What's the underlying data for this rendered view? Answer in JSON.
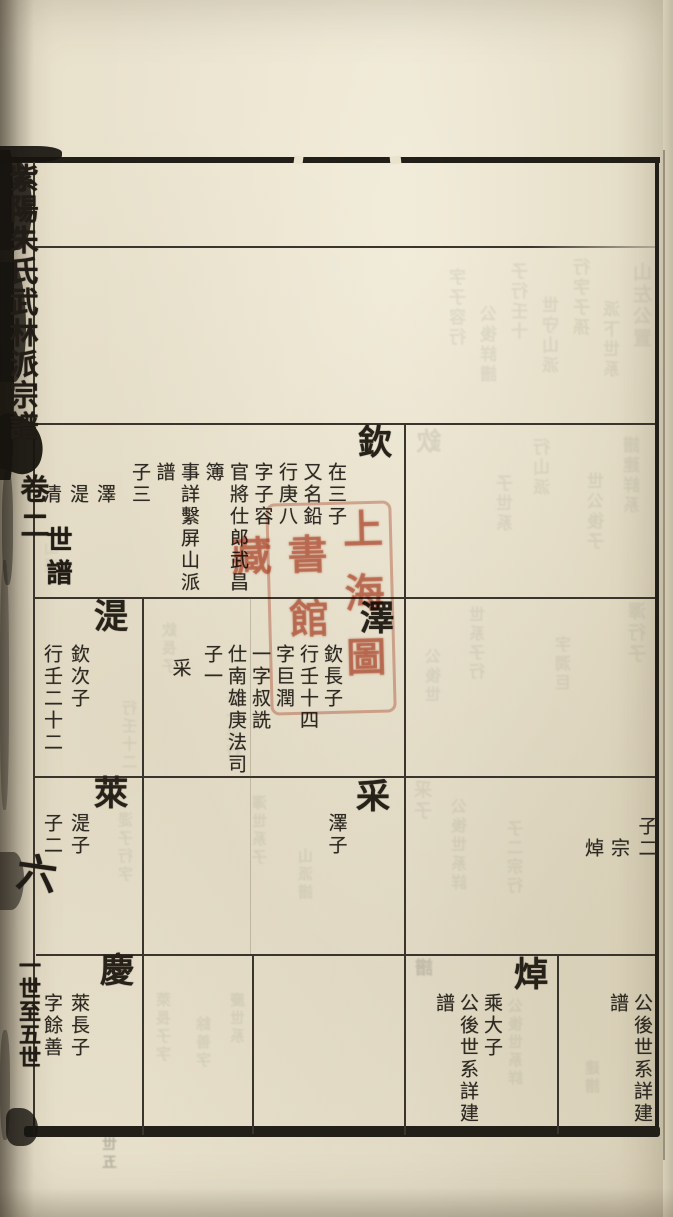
{
  "spine": {
    "title": "紫陽朱氏武林派宗譜",
    "volume": "卷二",
    "section": "世譜",
    "leaf_no": "六",
    "range_note": "一世至五世"
  },
  "cells": {
    "qin": {
      "name": "欽",
      "details": "在三子\n又名鉛\n行庚八\n字子容\n官將仕郎武昌\n簿\n事詳繫屏山派\n譜\n子三",
      "sons": "澤\n湜\n清"
    },
    "ze": {
      "name": "澤",
      "details": "欽長子\n行壬十四\n字巨潤\n一字叔詵\n仕南雄庚法司\n子一",
      "sons": "采"
    },
    "shi": {
      "name": "湜",
      "details": "欽次子\n行壬二十二"
    },
    "lai": {
      "name": "萊",
      "details": "湜子\n子二"
    },
    "cai": {
      "name": "采",
      "details": "澤子"
    },
    "cont": {
      "details": "子二",
      "sons": "宗\n焯"
    },
    "qing": {
      "name": "慶",
      "details": "萊長子\n字餘善"
    },
    "zhuo": {
      "name": "焯",
      "details": "乘大子\n公後世系詳建\n譜"
    },
    "note": {
      "details": "公後世系詳建\n譜"
    }
  },
  "seal": {
    "right_column": "上海圖",
    "left_column": "書館藏",
    "color": "#ba482d"
  },
  "ghosts": [
    {
      "x": 633,
      "y": 262,
      "t": "山左公置",
      "f": 19
    },
    {
      "x": 604,
      "y": 300,
      "t": "派下世系",
      "f": 17
    },
    {
      "x": 574,
      "y": 258,
      "t": "行字子孫",
      "f": 17
    },
    {
      "x": 543,
      "y": 296,
      "t": "世守山派",
      "f": 17
    },
    {
      "x": 512,
      "y": 262,
      "t": "子行壬十",
      "f": 17
    },
    {
      "x": 481,
      "y": 305,
      "t": "公後詳譜",
      "f": 17
    },
    {
      "x": 450,
      "y": 268,
      "t": "字子容行",
      "f": 17
    },
    {
      "x": 416,
      "y": 428,
      "t": "欽",
      "f": 25,
      "o": 0.16
    },
    {
      "x": 624,
      "y": 436,
      "t": "譜建詳系",
      "f": 17
    },
    {
      "x": 588,
      "y": 472,
      "t": "世公後子",
      "f": 17
    },
    {
      "x": 534,
      "y": 438,
      "t": "行山派",
      "f": 17
    },
    {
      "x": 497,
      "y": 474,
      "t": "子世系",
      "f": 17
    },
    {
      "x": 44,
      "y": 540,
      "t": "山派",
      "f": 15,
      "o": 0.1
    },
    {
      "x": 628,
      "y": 602,
      "t": "澤行子",
      "f": 18
    },
    {
      "x": 556,
      "y": 636,
      "t": "字潤巨",
      "f": 16
    },
    {
      "x": 470,
      "y": 606,
      "t": "世系子行",
      "f": 16
    },
    {
      "x": 426,
      "y": 648,
      "t": "公後世",
      "f": 16
    },
    {
      "x": 122,
      "y": 700,
      "t": "行壬十二",
      "f": 15
    },
    {
      "x": 226,
      "y": 690,
      "t": "子一采行",
      "f": 15
    },
    {
      "x": 162,
      "y": 622,
      "t": "欽長子",
      "f": 15
    },
    {
      "x": 118,
      "y": 812,
      "t": "湜子行字",
      "f": 15
    },
    {
      "x": 252,
      "y": 795,
      "t": "澤世系子",
      "f": 15
    },
    {
      "x": 298,
      "y": 848,
      "t": "山派譜",
      "f": 15
    },
    {
      "x": 452,
      "y": 798,
      "t": "公後世系詳",
      "f": 16
    },
    {
      "x": 508,
      "y": 820,
      "t": "子二宗行",
      "f": 16
    },
    {
      "x": 414,
      "y": 780,
      "t": "采子",
      "f": 18
    },
    {
      "x": 156,
      "y": 992,
      "t": "萊長子字",
      "f": 15
    },
    {
      "x": 196,
      "y": 1016,
      "t": "餘善字",
      "f": 15
    },
    {
      "x": 230,
      "y": 992,
      "t": "慶世系",
      "f": 15
    },
    {
      "x": 415,
      "y": 958,
      "t": "譜",
      "f": 18,
      "o": 0.28
    },
    {
      "x": 508,
      "y": 998,
      "t": "公後世系詳",
      "f": 15
    },
    {
      "x": 585,
      "y": 1060,
      "t": "建譜",
      "f": 15
    },
    {
      "x": 102,
      "y": 1136,
      "t": "世五",
      "f": 15,
      "o": 0.4
    }
  ]
}
